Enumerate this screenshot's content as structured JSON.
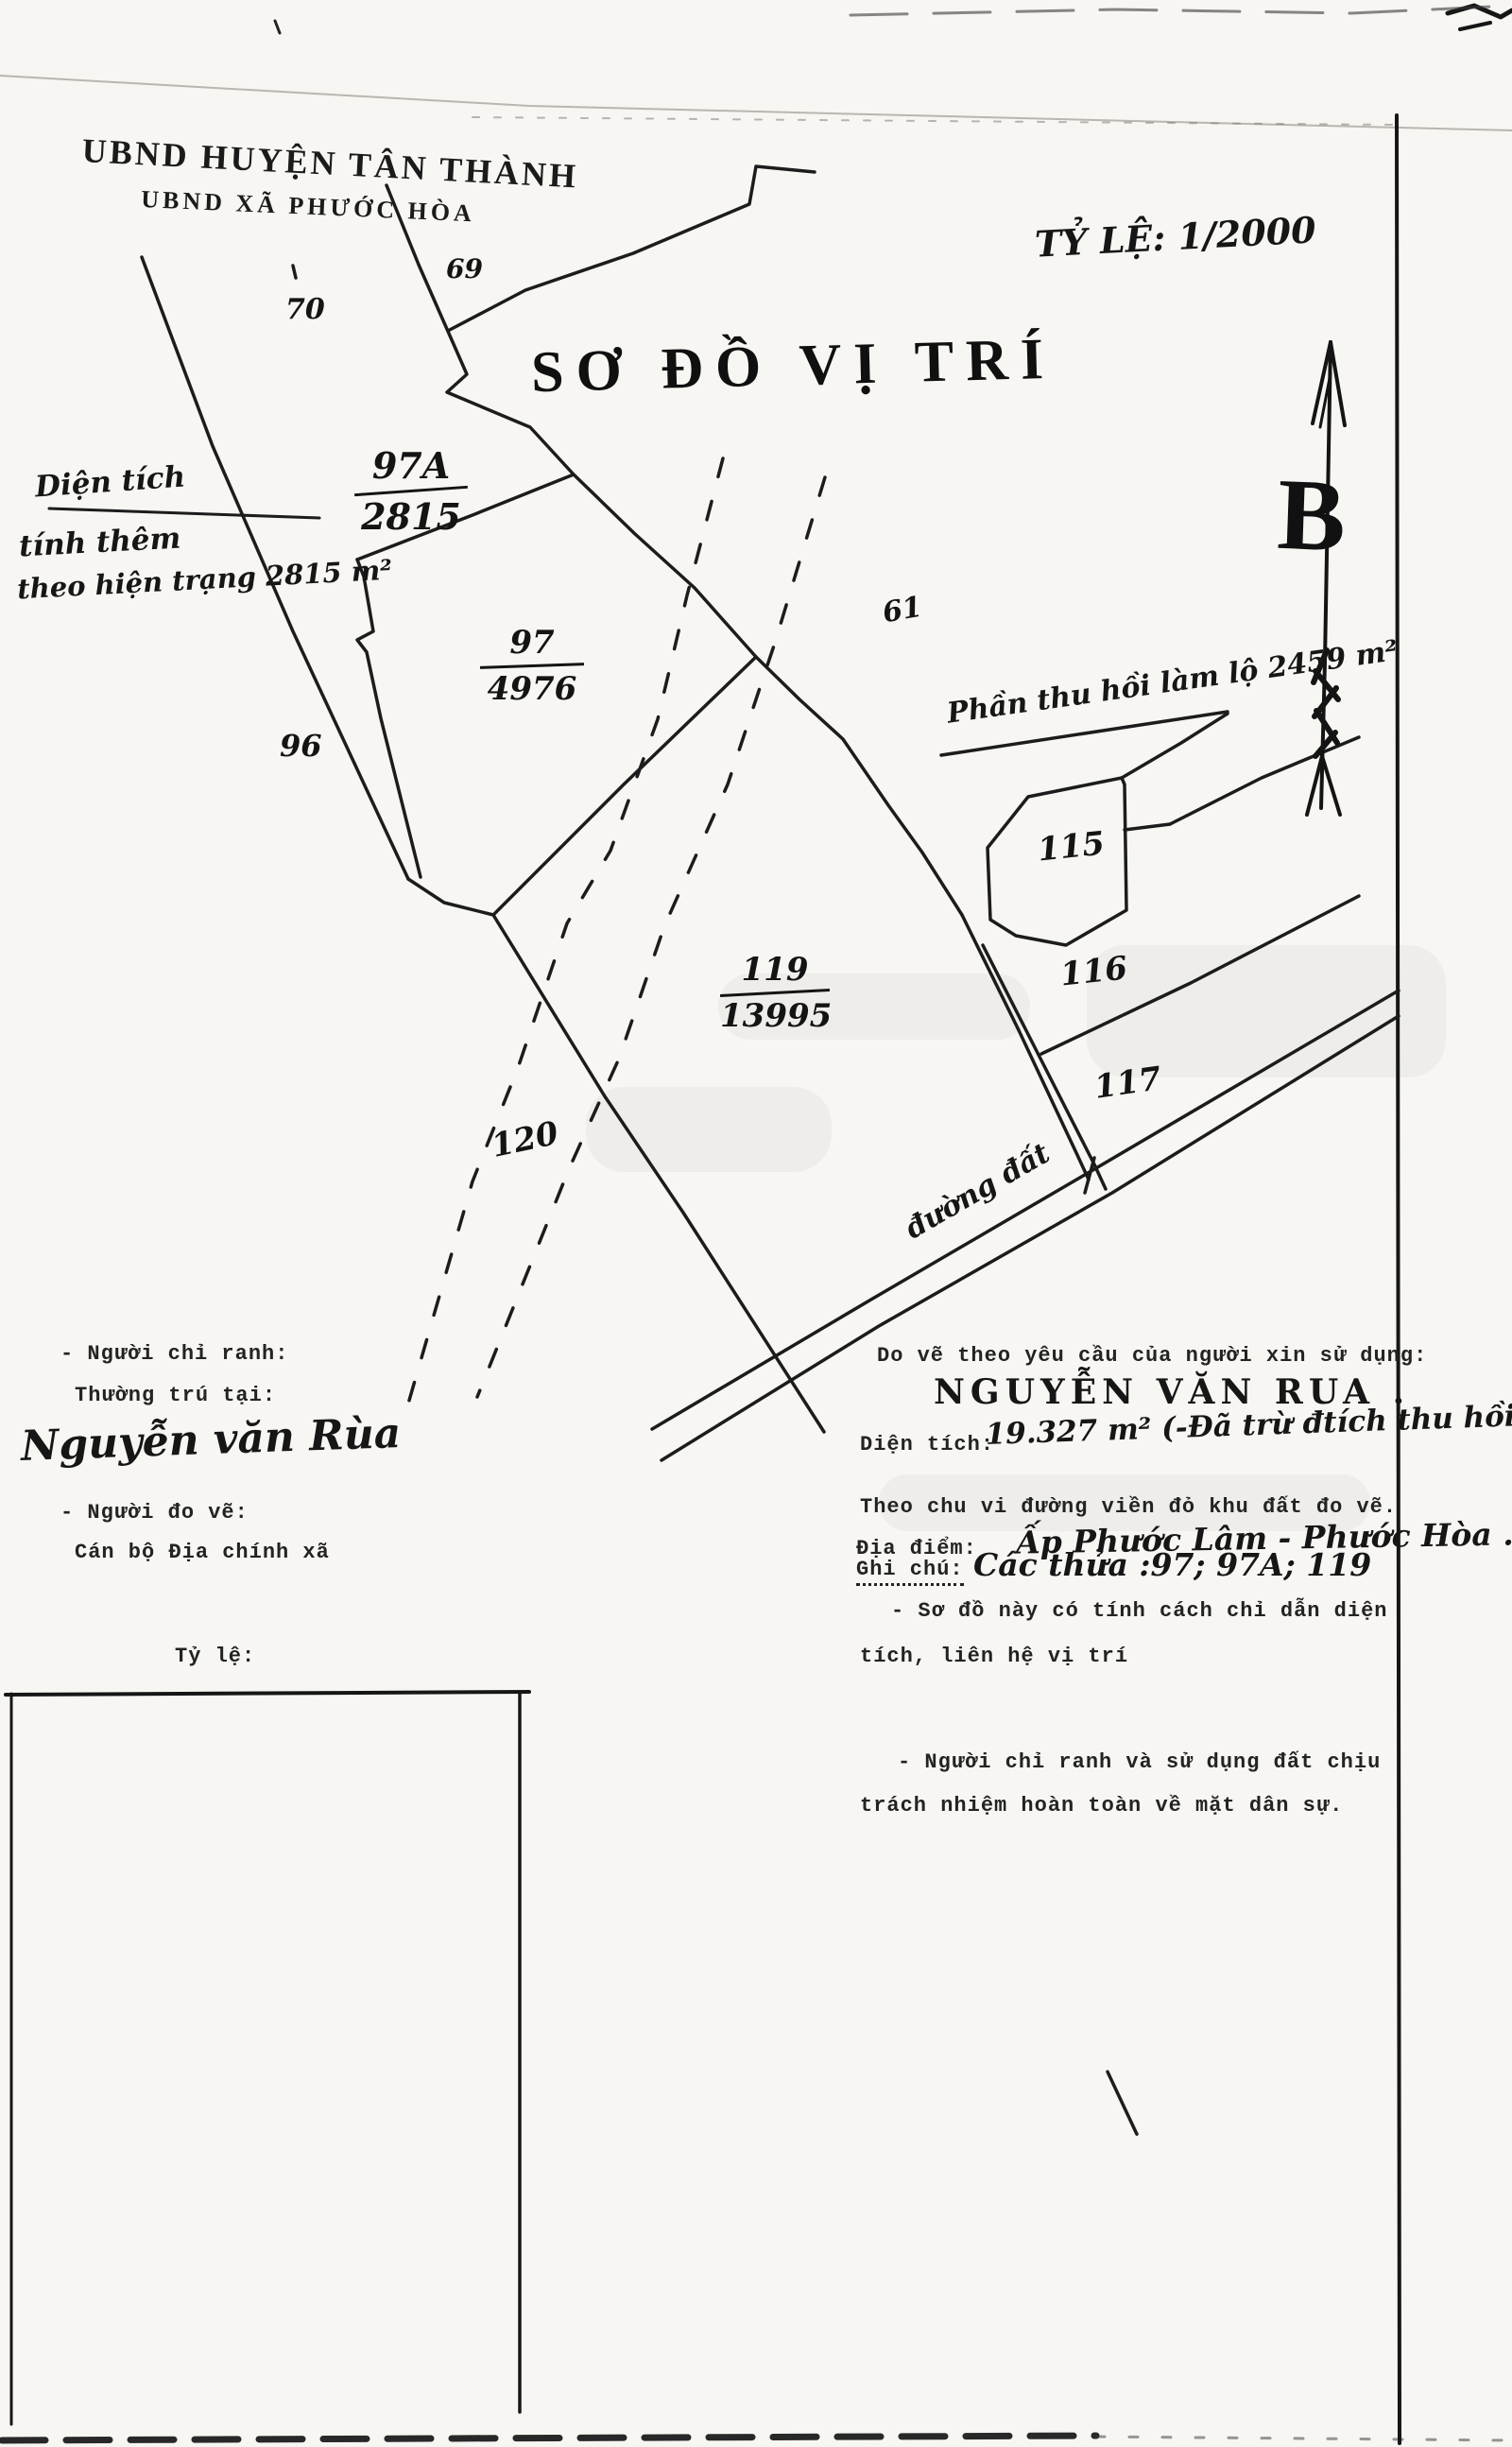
{
  "page": {
    "header_line1": "UBND HUYỆN TÂN THÀNH",
    "header_line2": "UBND XÃ PHƯỚC HÒA",
    "scale_note": "TỶ LỆ: 1/2000",
    "title": "SƠ ĐỒ VỊ TRÍ",
    "north_label": "B"
  },
  "map": {
    "area_note": {
      "line1": "Diện tích",
      "line2": "tính thêm",
      "line3": "theo hiện trạng 2815 m²"
    },
    "recovery_note": "Phần thu hồi làm lộ 2459 m²",
    "road_label": "đường đất",
    "parcels": {
      "p97a": {
        "id": "97A",
        "area": "2815"
      },
      "p97": {
        "id": "97",
        "area": "4976"
      },
      "p119": {
        "id": "119",
        "area": "13995"
      },
      "p96": "96",
      "p70": "70",
      "p69": "69",
      "p61": "61",
      "p115": "115",
      "p116": "116",
      "p117": "117",
      "p120": "120"
    }
  },
  "left_block": {
    "line1": "- Người chỉ ranh:",
    "line2": "Thường trú tại:",
    "name_handwritten": "Nguyễn văn Rùa",
    "line3": "- Người đo vẽ:",
    "line4": "Cán bộ Địa chính xã",
    "scale_label": "Tỷ lệ:"
  },
  "right_block": {
    "request_line": "Do vẽ theo yêu cầu của người xin sử dụng:",
    "applicant_name": "NGUYỄN VĂN RUA .",
    "area_label": "Diện tích:",
    "area_value": "19.327 m² (-Đã trừ đtích thu hồi làm đ",
    "perimeter_line": "Theo chu vi đường viền đỏ khu đất đo vẽ.",
    "location_label": "Địa điểm:",
    "location_value": "Ấp Phước Lâm - Phước Hòa .",
    "note_label": "Ghi chú:",
    "note_value": "Các thửa :97; 97A; 119",
    "note_line2": "- Sơ đồ này có tính cách  chỉ dẫn diện",
    "note_line3": "tích, liên hệ vị trí",
    "liability_line1": "- Người chỉ ranh  và sử dụng đất  chịu",
    "liability_line2": "trách nhiệm hoàn toàn về mặt dân sự."
  }
}
